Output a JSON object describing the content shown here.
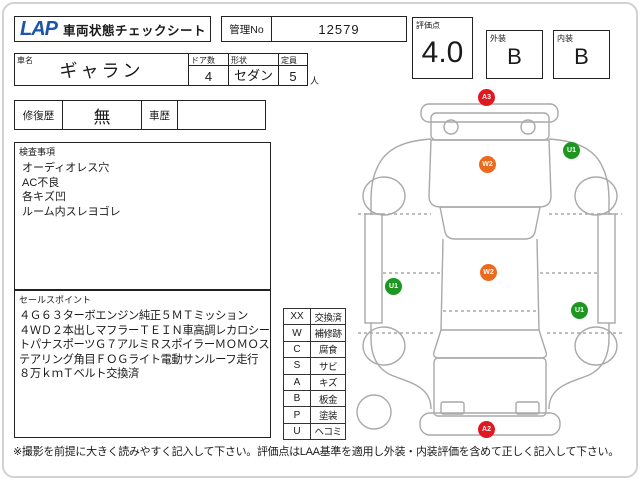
{
  "header": {
    "logo": "LAP",
    "title": "車両状態チェックシート",
    "control_no_label": "管理No",
    "control_no_value": "12579",
    "score": {
      "label": "評価点",
      "value": "4.0"
    },
    "exterior": {
      "label": "外装",
      "value": "B"
    },
    "interior": {
      "label": "内装",
      "value": "B"
    }
  },
  "vehicle": {
    "name_label": "車名",
    "name_value": "ギャラン",
    "doors_label": "ドア数",
    "doors_value": "4",
    "shape_label": "形状",
    "shape_value": "セダン",
    "capacity_label": "定員",
    "capacity_value": "5",
    "capacity_unit": "人"
  },
  "history": {
    "repair_label": "修復歴",
    "repair_value": "無",
    "car_history_label": "車歴",
    "car_history_value": ""
  },
  "inspection": {
    "label": "検査事項",
    "items": [
      "オーディオレス穴",
      "AC不良",
      "各キズ凹",
      "ルーム内スレヨゴレ"
    ]
  },
  "sales": {
    "label": "セールスポイント",
    "lines": [
      "４Ｇ６３ターボエンジン純正５ＭＴミッション",
      "４ＷＤ２本出しマフラーＴＥＩＮ車高調レカロシー",
      "トパナスポーツＧ７アルミＲスポイラーＭＯＭＯス",
      "テアリング角目ＦＯＧライト電動サンルーフ走行",
      "８万ｋｍＴベルト交換済"
    ]
  },
  "legend": {
    "rows": [
      {
        "code": "XX",
        "label": "交換済"
      },
      {
        "code": "W",
        "label": "補修跡"
      },
      {
        "code": "C",
        "label": "腐食"
      },
      {
        "code": "S",
        "label": "サビ"
      },
      {
        "code": "A",
        "label": "キズ"
      },
      {
        "code": "B",
        "label": "板金"
      },
      {
        "code": "P",
        "label": "塗装"
      },
      {
        "code": "U",
        "label": "ヘコミ"
      }
    ]
  },
  "diagram": {
    "markers": [
      {
        "code": "A3",
        "color": "#e01820",
        "location": "front-bumper"
      },
      {
        "code": "W2",
        "color": "#ec6a1e",
        "location": "hood"
      },
      {
        "code": "U1",
        "color": "#1e9622",
        "location": "right-front-fender"
      },
      {
        "code": "W2",
        "color": "#ec6a1e",
        "location": "roof"
      },
      {
        "code": "U1",
        "color": "#1e9622",
        "location": "left-door"
      },
      {
        "code": "U1",
        "color": "#1e9622",
        "location": "right-rear-door"
      },
      {
        "code": "A2",
        "color": "#e01820",
        "location": "rear-bumper"
      }
    ]
  },
  "footer": {
    "note": "※撮影を前提に大きく読みやすく記入して下さい。評価点はLAA基準を適用し外装・内装評価を含めて正しく記入して下さい。"
  },
  "colors": {
    "logo_blue": "#1d55a8",
    "marker_red": "#e01820",
    "marker_orange": "#ec6a1e",
    "marker_green": "#1e9622",
    "outline_gray": "#a9a9a9"
  }
}
